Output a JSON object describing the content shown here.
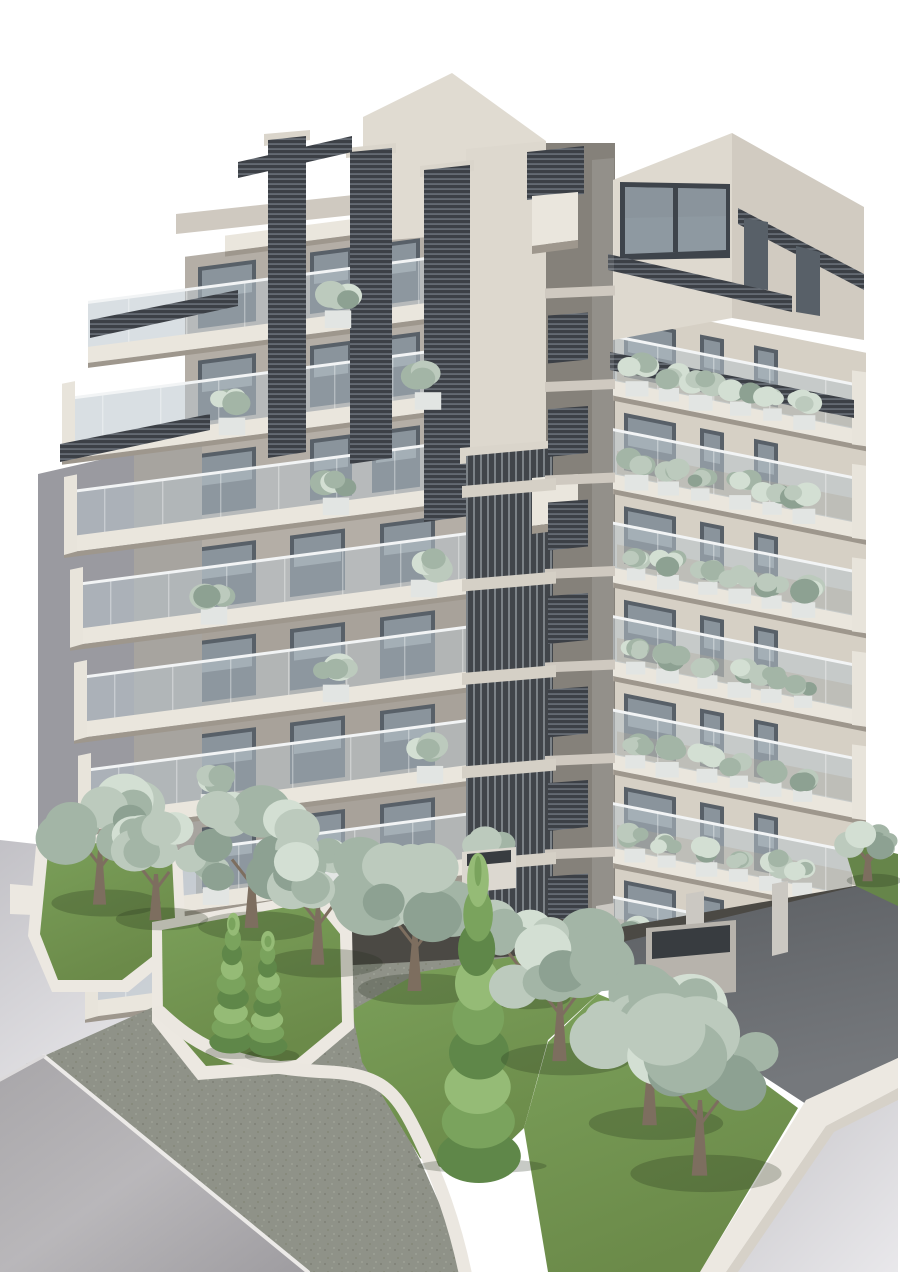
{
  "scene": {
    "name": "apartment-building-exterior-render",
    "width": 900,
    "height": 1272,
    "sky": "#ffffff"
  },
  "palette": {
    "sky": "#ffffff",
    "wall_left": "#b4aea6",
    "wall_left_low": "#a8a29a",
    "wall_right": "#d6d0c5",
    "tower": "#e0dbd1",
    "tower_lower": "#ddd8ce",
    "rt_front": "#ded9cf",
    "rt_side": "#d1cbc1",
    "roof_band": "#cfc9c0",
    "slot": "#85817a",
    "slab": "#eae6dd",
    "slab_shadow": "#9e978d",
    "side_return": "#e8e4db",
    "glass": "rgba(186,197,204,0.55)",
    "glass_rail": "#f2f4f5",
    "window": "#586068",
    "window_hi": "#8a949c",
    "win_frame": "#3e444b",
    "win_glass": "#8e99a1",
    "louver_dark": "#3c4046",
    "louver_line": "#757c84",
    "cap": "#dad5cb",
    "stub": "#d5d0c6",
    "neighbor_a": "#9a9aa0",
    "neighbor_b": "#a7a49f",
    "shadow_band": "#4b4944",
    "sidewalk": "#8f9288",
    "wall_white": "#ece8e1",
    "wall_white_side": "#d6d1c8",
    "lawn_dark": "#66854a",
    "box_white": "#e2e5e3",
    "box_side": "#dcd8d0",
    "box_top_dark": "#383c40",
    "column": "#cbc8c2",
    "planter_wall": "#b7b3ac",
    "interior": "rgba(160,138,95,0.35)",
    "sage": [
      "#8da192",
      "#a3b5a6",
      "#bccabd",
      "#d3dfd3"
    ],
    "cypress": [
      "#5f8749",
      "#7aa35d",
      "#95bb76"
    ],
    "trunk": "#7d6e5f",
    "tree_shadow": "rgba(30,45,25,0.25)"
  },
  "building": {
    "left_face": {
      "corner_x": 545,
      "wall_x": 185,
      "slope": 0.13,
      "pitch": 93.5,
      "top_y": 196,
      "stories": 8,
      "outers": [
        225,
        88,
        62,
        64,
        70,
        74,
        78,
        82,
        85
      ],
      "window_slots_upper": [
        [
          198,
          256
        ],
        [
          310,
          352
        ],
        [
          372,
          420
        ]
      ],
      "window_slots_lower": [
        [
          198,
          256
        ],
        [
          290,
          345
        ],
        [
          380,
          435
        ]
      ],
      "planters": {
        "0": [
          338
        ],
        "1": [
          232,
          428
        ],
        "2": [
          336
        ],
        "3": [
          214,
          424
        ],
        "4": [
          336
        ],
        "5": [
          214,
          430
        ],
        "6": [
          216,
          336
        ],
        "7": [
          420
        ]
      }
    },
    "right_face": {
      "corner_x": 615,
      "right_x": 866,
      "slope": 0.2,
      "pitch": 93.5,
      "top_y": 196,
      "first_story": 1,
      "first_slab": 2,
      "last_slab": 8,
      "window_slots": [
        [
          624,
          676
        ],
        [
          700,
          724
        ],
        [
          754,
          778
        ]
      ],
      "shrubs": {
        "start_x": 636,
        "step": 34,
        "count": 6
      }
    },
    "corner_slot": {
      "x1": 545,
      "x2": 615,
      "top": 143,
      "bottom": 948,
      "pitch": 93.5,
      "top_y": 196
    }
  },
  "static": {
    "pre": [
      {
        "n": "corner-slot-back",
        "p": "545,143 615,143 615,940 545,952",
        "f": "slot"
      }
    ],
    "neighbors": [
      {
        "n": "neighbor-wall-far",
        "p": "38,474 134,452 134,906 38,920",
        "f": "neighbor_a"
      },
      {
        "n": "neighbor-wall-near",
        "p": "134,452 202,446 202,900 134,906",
        "f": "neighbor_b"
      },
      {
        "n": "neighbor-wall-low",
        "p": "0,840 196,862 196,1020 0,1082",
        "f": "url(#gradWallLight)"
      },
      {
        "n": "neighbor-parapet",
        "p": "10,884 58,888 58,916 10,914",
        "f": "wall_white"
      }
    ],
    "mid": [
      {
        "n": "tower-front",
        "p": "363,117 452,73 546,141 546,228 363,242",
        "f": "tower"
      },
      {
        "n": "tower-lower-wall",
        "p": "466,149 546,141 546,470 466,484",
        "f": "tower_lower"
      },
      {
        "n": "left-volume-roof-band",
        "p": "176,214 363,194 363,214 176,234",
        "f": "roof_band"
      },
      {
        "n": "corner-louver-box",
        "p": "527,152 584,146 584,194 527,200",
        "f": "url(#patLouvH)"
      },
      {
        "n": "right-tower-front",
        "p": "613,180 732,133 732,318 613,340",
        "f": "rt_front"
      },
      {
        "n": "right-tower-side",
        "p": "732,133 864,207 864,340 732,318",
        "f": "rt_side"
      },
      {
        "n": "right-tower-roof-louver",
        "p": "738,208 864,274 864,290 738,224",
        "f": "url(#patLouvH)"
      },
      {
        "n": "right-tower-window-frame",
        "p": "620,182 730,184 730,258 620,260",
        "f": "win_frame"
      },
      {
        "n": "right-tower-window-glass",
        "p": "625,187 726,189 726,250 625,254",
        "f": "win_glass"
      },
      {
        "n": "right-tower-window-hi",
        "p": "625,187 726,189 726,216 625,218",
        "f": "window_hi"
      },
      {
        "n": "right-tower-window-mullion",
        "p": "673,188 678,188 678,252 673,252",
        "f": "win_frame"
      },
      {
        "n": "right-tower-side-window-1",
        "p": "744,218 768,222 768,290 744,288",
        "f": "window"
      },
      {
        "n": "right-tower-side-window-2",
        "p": "796,246 820,252 820,316 796,312",
        "f": "window"
      },
      {
        "n": "pergola-right-upper",
        "p": "608,254 792,296 792,312 608,270",
        "f": "url(#patLouvH)"
      },
      {
        "n": "pergola-right-lower",
        "p": "610,352 854,400 854,418 610,370",
        "f": "url(#patLouvH)"
      },
      {
        "n": "louver-col-1-cap",
        "p": "264,134 310,130 310,140 264,146",
        "f": "cap"
      },
      {
        "n": "louver-col-1",
        "p": "268,140 306,136 306,452 268,458",
        "f": "url(#patLouvH)"
      },
      {
        "n": "louver-col-2-cap",
        "p": "346,148 396,143 396,153 346,158",
        "f": "cap"
      },
      {
        "n": "louver-col-2",
        "p": "350,152 392,148 392,458 350,464",
        "f": "url(#patLouvH)"
      },
      {
        "n": "louver-col-3-cap",
        "p": "420,166 474,160 474,171 420,177",
        "f": "cap"
      },
      {
        "n": "louver-col-3",
        "p": "424,170 470,165 470,516 424,522",
        "f": "url(#patLouvH)"
      },
      {
        "n": "pergola-left-0",
        "p": "238,162 352,136 352,152 238,178",
        "f": "url(#patLouvH)"
      },
      {
        "n": "pergola-left-1",
        "p": "90,320 238,290 238,306 90,338",
        "f": "url(#patLouvH)"
      },
      {
        "n": "pergola-left-2",
        "p": "60,444 210,414 210,430 60,462",
        "f": "url(#patLouvH)"
      },
      {
        "n": "vertical-louver-cap",
        "p": "460,448 558,440 558,456 460,464",
        "f": "cap"
      },
      {
        "n": "vertical-louver-screen",
        "p": "466,456 553,448 553,940 466,948",
        "f": "url(#patLouvV)"
      },
      {
        "n": "slot-white-box-1",
        "p": "532,196 578,192 578,240 532,246",
        "f": "slab"
      },
      {
        "n": "slot-white-box-1-shade",
        "p": "532,246 578,240 578,248 532,254",
        "f": "slab_shadow"
      },
      {
        "n": "slot-white-box-2",
        "p": "532,478 578,474 578,520 532,526",
        "f": "slab"
      },
      {
        "n": "slot-white-box-2-shade",
        "p": "532,526 578,520 578,528 532,534",
        "f": "slab_shadow"
      },
      {
        "n": "slot-glass-hint",
        "p": "592,160 614,158 614,938 592,940",
        "f": "rgba(255,255,255,0.12)"
      }
    ],
    "ground": [
      {
        "n": "building-ground-shadow",
        "p": "178,930 545,916 615,928 866,884 866,908 615,956 545,968 178,976",
        "f": "shadow_band"
      },
      {
        "n": "sidewalk",
        "p": "26,1064 160,1004 300,968 520,956 610,944 660,964 560,978 470,996 400,1020 362,1050 420,1160 470,1272 298,1272",
        "f": "url(#patSidewalk)"
      },
      {
        "n": "road-left",
        "p": "0,1080 44,1056 308,1272 0,1272",
        "f": "url(#gradRoad)"
      },
      {
        "n": "driveway",
        "p": "580,952 866,884 898,900 898,1058 806,1104 640,996",
        "f": "url(#gradDrive)"
      },
      {
        "n": "road-right",
        "p": "898,1088 826,1126 726,1272 898,1272",
        "f": "url(#gradLightRoad)"
      },
      {
        "n": "perimeter-wall-top",
        "p": "898,1058 806,1100 700,1272 726,1272 826,1126 898,1088",
        "f": "wall_white"
      },
      {
        "n": "perimeter-wall-side",
        "p": "898,1088 826,1126 726,1272 738,1272 834,1132 898,1100",
        "f": "wall_white_side"
      },
      {
        "n": "lawn-front-right",
        "p": "598,994 700,1036 798,1108 700,1272 548,1272 524,1128 548,1042",
        "f": "url(#gradLawn)"
      },
      {
        "n": "lawn-mid-right",
        "p": "352,1010 420,972 515,956 600,992 548,1040 524,1128 470,1180 420,1158 362,1062",
        "f": "url(#gradLawn)"
      },
      {
        "n": "grass-right-strip",
        "p": "842,840 898,854 898,906 856,886",
        "f": "lawn_dark"
      },
      {
        "n": "bed-left-wall",
        "p": "36,846 150,824 182,854 186,944 128,992 52,992 28,936",
        "f": "wall_white"
      },
      {
        "n": "bed-left-grass",
        "p": "48,852 146,834 172,858 176,938 122,980 58,980 40,934",
        "f": "url(#gradLawn)"
      },
      {
        "n": "bed-mid-wall",
        "p": "152,922 322,892 352,930 354,1028 302,1072 198,1080 152,1022",
        "f": "wall_white"
      },
      {
        "n": "bed-mid-grass",
        "p": "162,930 314,902 340,934 342,1022 296,1060 206,1066 163,1016",
        "f": "url(#gradLawn)"
      },
      {
        "n": "terrace-planter-1",
        "p": "388,862 448,856 448,900 388,906",
        "f": "box_side"
      },
      {
        "n": "terrace-planter-1-top",
        "p": "393,864 443,859 443,872 393,877",
        "f": "box_top_dark"
      },
      {
        "n": "terrace-planter-2",
        "p": "462,852 516,847 516,888 462,893",
        "f": "box_side"
      },
      {
        "n": "terrace-planter-2-top",
        "p": "467,854 511,850 511,862 467,866",
        "f": "box_top_dark"
      },
      {
        "n": "pilotis-column-1",
        "p": "596,906 614,903 614,972 596,976",
        "f": "column"
      },
      {
        "n": "pilotis-column-2",
        "p": "686,894 704,891 704,964 686,968",
        "f": "column"
      },
      {
        "n": "pilotis-column-3",
        "p": "772,884 788,881 788,952 772,956",
        "f": "column"
      },
      {
        "n": "pilotis-planter",
        "p": "646,928 736,920 736,992 646,1000",
        "f": "planter_wall"
      },
      {
        "n": "pilotis-planter-top",
        "p": "652,932 730,925 730,952 652,959",
        "f": "box_top_dark"
      }
    ],
    "paths": [
      {
        "n": "curb-line",
        "d": "M44,1056 L308,1272",
        "s": "#eceae8",
        "w": 4
      },
      {
        "n": "curb-line-corner",
        "d": "M0,1080 L44,1056",
        "s": "#dcdadb",
        "w": 3
      },
      {
        "n": "planter-snake-wall",
        "d": "M160,1012 C200,1050 240,1068 330,1072 C380,1075 395,1090 415,1130 C440,1180 455,1225 465,1272",
        "s": "#ebe7e0",
        "w": 13
      }
    ]
  },
  "trees": [
    {
      "t": "sage",
      "x": 100,
      "y": 850,
      "r": 52,
      "s": 11
    },
    {
      "t": "sage",
      "x": 156,
      "y": 874,
      "r": 44,
      "s": 12
    },
    {
      "t": "sage",
      "x": 252,
      "y": 868,
      "r": 57,
      "s": 13
    },
    {
      "t": "sage",
      "x": 318,
      "y": 906,
      "r": 56,
      "s": 14
    },
    {
      "t": "cypress",
      "x": 232,
      "y": 1048,
      "h": 128,
      "w": 36,
      "s": 15
    },
    {
      "t": "cypress",
      "x": 268,
      "y": 1052,
      "h": 114,
      "w": 32,
      "s": 16
    },
    {
      "t": "sage",
      "x": 415,
      "y": 928,
      "r": 60,
      "s": 17
    },
    {
      "t": "sage",
      "x": 522,
      "y": 958,
      "r": 40,
      "s": 23
    },
    {
      "t": "cypress",
      "x": 478,
      "y": 1162,
      "h": 300,
      "w": 76,
      "s": 18
    },
    {
      "t": "sage",
      "x": 560,
      "y": 996,
      "r": 62,
      "s": 19
    },
    {
      "t": "sage",
      "x": 650,
      "y": 1058,
      "r": 64,
      "s": 20
    },
    {
      "t": "sage",
      "x": 700,
      "y": 1100,
      "r": 72,
      "s": 21
    },
    {
      "t": "sage",
      "x": 868,
      "y": 854,
      "r": 26,
      "s": 22
    }
  ]
}
